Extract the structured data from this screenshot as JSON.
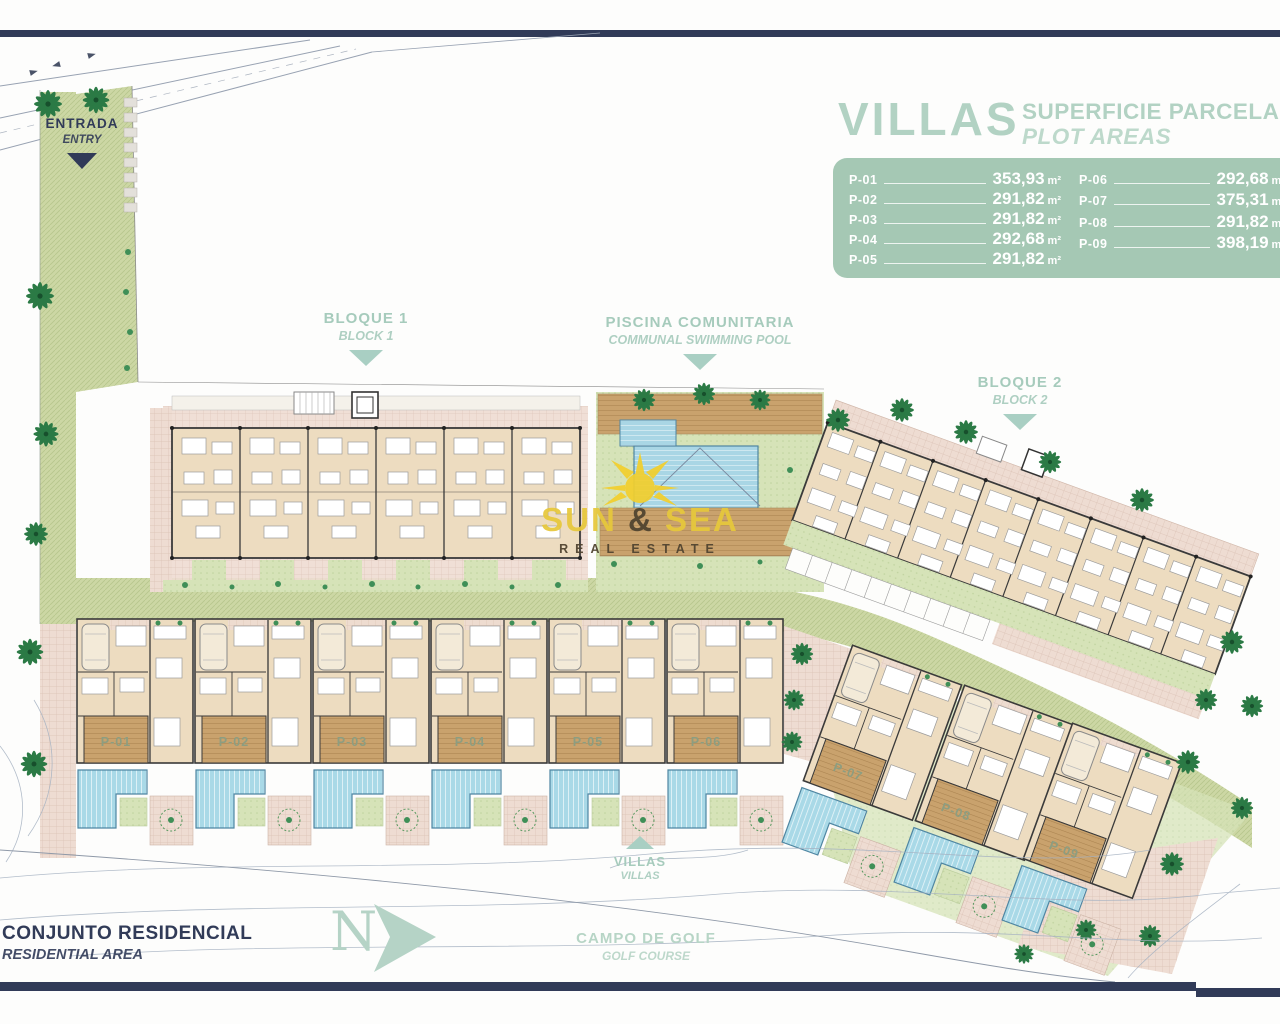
{
  "colors": {
    "navy": "#313b58",
    "heading_green": "#a6cbbc",
    "legend_bg": "#a5c8b4",
    "legend_text": "#ffffff",
    "title_green": "#b2d2c3",
    "sun_yellow": "#e7c83b",
    "brand_brown": "#4f432f",
    "pool_blue": "#a9d9e7",
    "lawn_green": "#d6e3b8",
    "deck_brown": "#c9a26d",
    "palm_green": "#2b7a45"
  },
  "entrance": {
    "title": "ENTRADA",
    "subtitle": "ENTRY"
  },
  "markers": {
    "block1": {
      "title": "BLOQUE 1",
      "subtitle": "BLOCK 1"
    },
    "communal_pool": {
      "title": "PISCINA COMUNITARIA",
      "subtitle": "COMMUNAL SWIMMING POOL"
    },
    "block2": {
      "title": "BLOQUE 2",
      "subtitle": "BLOCK 2"
    },
    "villas": {
      "title": "VILLAS",
      "subtitle": "VILLAS"
    },
    "residential": {
      "title": "CONJUNTO RESIDENCIAL",
      "subtitle": "RESIDENTIAL AREA"
    },
    "golf": {
      "title": "CAMPO DE GOLF",
      "subtitle": "GOLF COURSE"
    },
    "compass": {
      "letter": "N"
    }
  },
  "legend": {
    "title": "VILLAS",
    "subtitle": "SUPERFICIE PARCELA",
    "subtitle_en": "PLOT AREAS",
    "unit": "m²",
    "plots": [
      {
        "id": "P-01",
        "area": "353,93"
      },
      {
        "id": "P-02",
        "area": "291,82"
      },
      {
        "id": "P-03",
        "area": "291,82"
      },
      {
        "id": "P-04",
        "area": "292,68"
      },
      {
        "id": "P-05",
        "area": "291,82"
      },
      {
        "id": "P-06",
        "area": "292,68"
      },
      {
        "id": "P-07",
        "area": "375,31"
      },
      {
        "id": "P-08",
        "area": "291,82"
      },
      {
        "id": "P-09",
        "area": "398,19"
      }
    ]
  },
  "watermark": {
    "brand_sun": "SUN",
    "brand_amp": "&",
    "brand_sea": "SEA",
    "tagline": "REAL ESTATE"
  },
  "villas": {
    "deck_labels": [
      "P-01",
      "P-02",
      "P-03",
      "P-04",
      "P-05",
      "P-06",
      "P-07",
      "P-08",
      "P-09"
    ]
  }
}
